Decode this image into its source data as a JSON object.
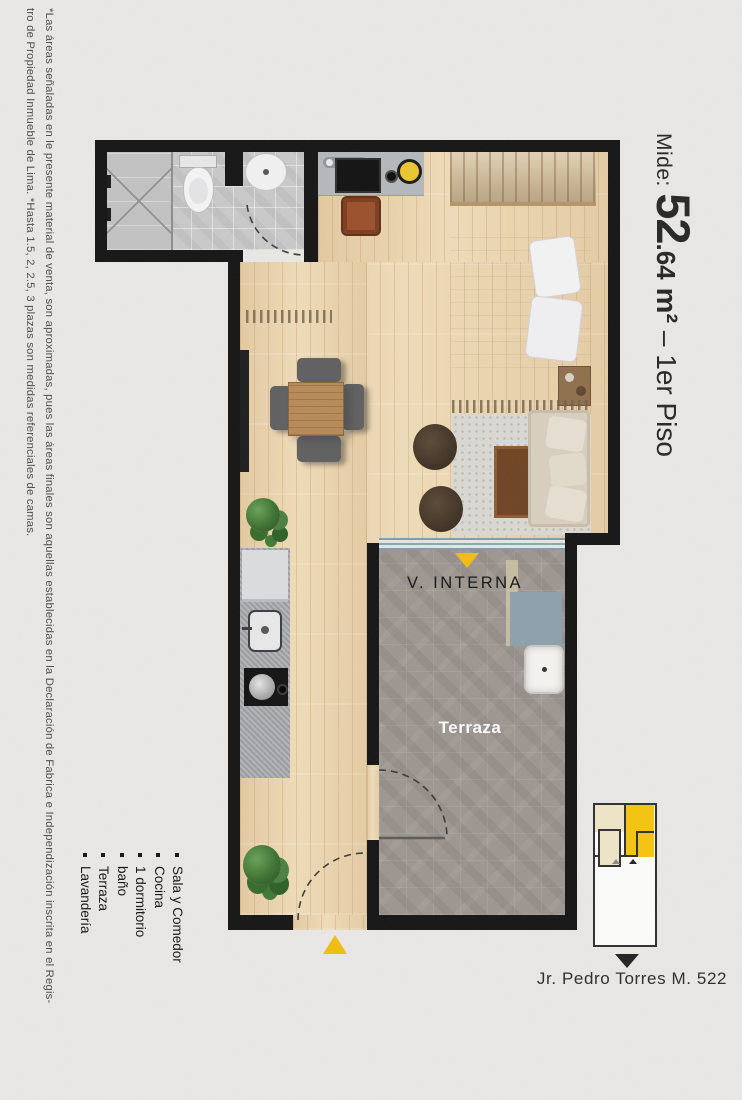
{
  "title": {
    "prefix": "Mide: ",
    "area_int": "52",
    "area_dec": ".64",
    "unit": " m²",
    "rest": " – 1er Piso"
  },
  "disclaimer": {
    "line1": "*Las áreas señaladas en le presente material de venta, son aproximadas, pues las áreas finales son aquellas establecidas en la Declaración de Fabrica e Independización inscrita en el Regis-",
    "line2": "tro de Propiedad Inmueble de Lima. *Hasta 1.5, 2, 2.5, 3 plazas son medidas referenciales de camas."
  },
  "rooms": {
    "items": [
      "Sala y Comedor",
      "Cocina",
      "1 dormitorio",
      "baño",
      "Terraza",
      "Lavandería"
    ]
  },
  "plan_labels": {
    "internal_view": "V. INTERNA",
    "terrace": "Terraza"
  },
  "keyplan": {
    "street": "Jr. Pedro Torres M. 522"
  },
  "icons": {
    "entrance-arrow-icon": "yellow triangle up",
    "internal-view-arrow-icon": "yellow triangle down",
    "street-arrow-icon": "black triangle down",
    "keyplan-unit-marker-icons": "small gray/black triangles up",
    "list-bullet-icon": "small black square"
  },
  "colors": {
    "background": "#e9e8e5",
    "wall": "#141414",
    "accent_yellow": "#f2bd0d",
    "keyplan_yellow": "#f6c40e",
    "keyplan_cream": "#efe5c6",
    "wood_floor": "#ecd7b2",
    "terrace_floor": "#9d9690",
    "bath_floor": "#c9c9c9",
    "text": "#262626"
  }
}
